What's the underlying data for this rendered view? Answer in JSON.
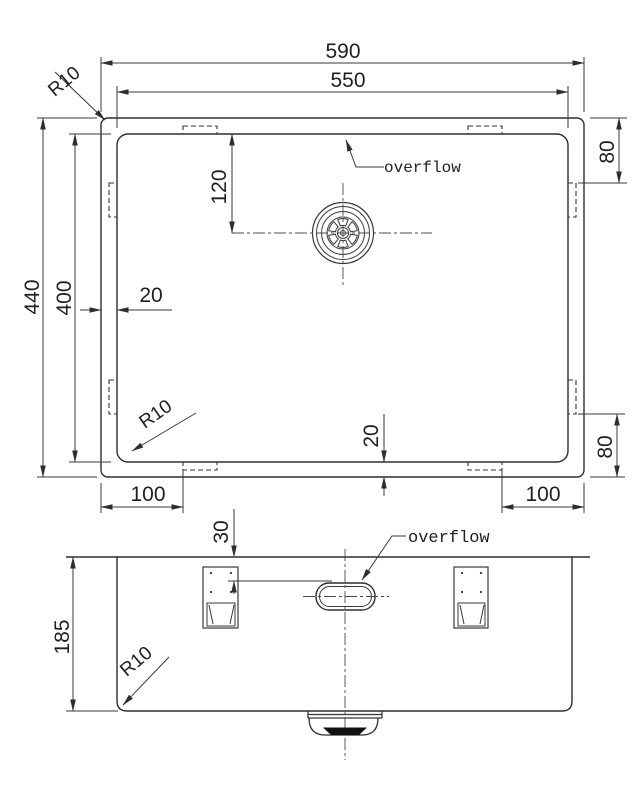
{
  "top_view": {
    "dim_outer_width": "590",
    "dim_inner_width": "550",
    "dim_outer_height": "440",
    "dim_inner_height": "400",
    "dim_drain_from_top": "120",
    "dim_rim_side": "20",
    "dim_rim_bottom": "20",
    "dim_clip_top_right": "80",
    "dim_clip_bottom_right": "80",
    "dim_clip_bottom_left": "100",
    "dim_clip_bottom_right_h": "100",
    "radius_top_left": "R10",
    "radius_bottom_left": "R10",
    "overflow_label": "overflow"
  },
  "front_view": {
    "dim_depth": "185",
    "dim_overflow_from_top": "30",
    "radius_bottom_left": "R10",
    "overflow_label": "overflow"
  },
  "colors": {
    "line": "#2e2e2e",
    "background": "#ffffff"
  }
}
